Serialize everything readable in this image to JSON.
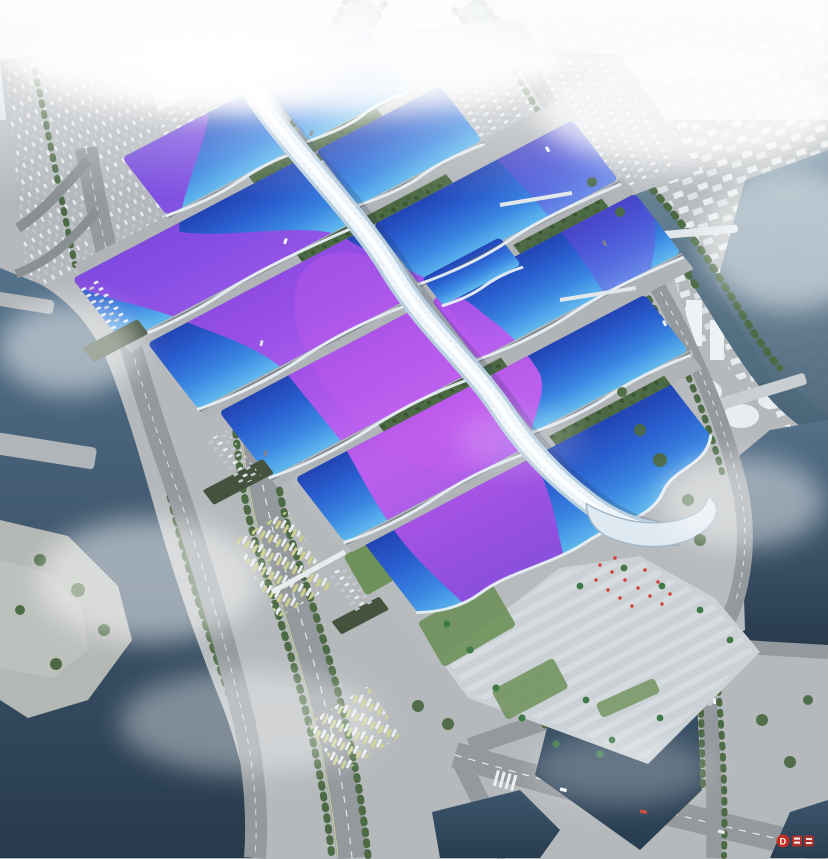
{
  "watermark": {
    "letter": "D"
  },
  "palette": {
    "haze": "#eef2f5",
    "ground": "#b5b9bc",
    "plaza": "#ccd2d6",
    "plaza-stripe": "#dde2e6",
    "road": "#94999d",
    "road-line": "#eceff1",
    "water-deep": "#273a4c",
    "water-mid": "#4a6478",
    "water-light": "#7b96a8",
    "tree": "#4c6a44",
    "tree-dark": "#3b5534",
    "lawn": "#6d9159",
    "palm": "#3f7a46",
    "roof-cyan": "#5fb9ee",
    "roof-blue": "#3a86e2",
    "roof-mid": "#2a60d0",
    "roof-deep": "#2244b4",
    "ribbon-magenta": "#c95ef0",
    "ribbon-purple": "#a14de8",
    "ribbon-violet": "#7a48de",
    "spine-white": "#e9f2f8",
    "spine-shade": "#b9cfdf",
    "city": "#eef2f4",
    "city-shade": "#ccd4d9",
    "shed": "#44523e",
    "accent-red": "#d23c34",
    "watermark-red": "#cf2a1e"
  }
}
